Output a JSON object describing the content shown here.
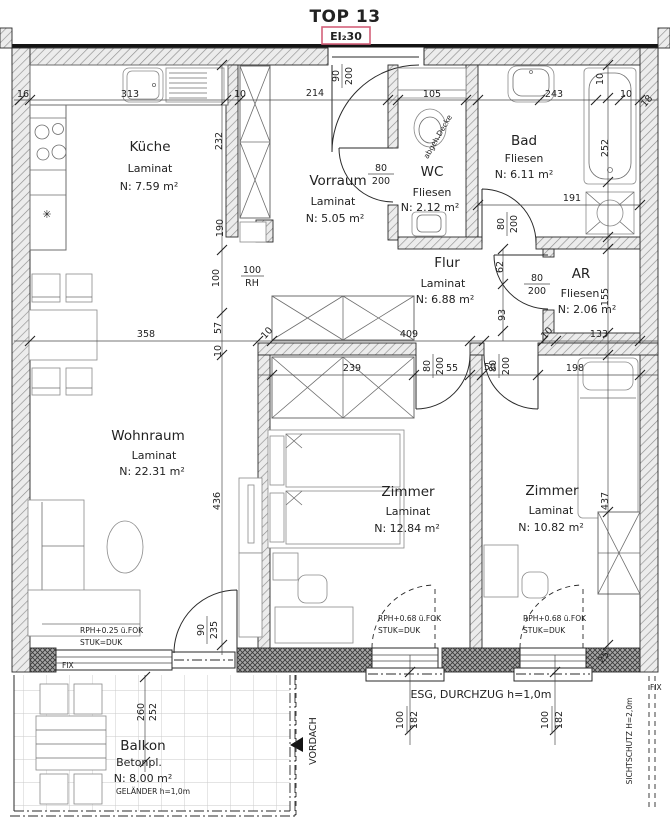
{
  "title": "TOP 13",
  "fire_label": "EI₂30",
  "rooms": {
    "kueche": {
      "name": "Küche",
      "floor": "Laminat",
      "area": "N: 7.59 m²"
    },
    "vorraum": {
      "name": "Vorraum",
      "floor": "Laminat",
      "area": "N: 5.05 m²"
    },
    "wc": {
      "name": "WC",
      "floor": "Fliesen",
      "area": "N: 2.12 m²"
    },
    "bad": {
      "name": "Bad",
      "floor": "Fliesen",
      "area": "N: 6.11 m²"
    },
    "flur": {
      "name": "Flur",
      "floor": "Laminat",
      "area": "N: 6.88 m²"
    },
    "ar": {
      "name": "AR",
      "floor": "Fliesen",
      "area": "N: 2.06 m²"
    },
    "wohnraum": {
      "name": "Wohnraum",
      "floor": "Laminat",
      "area": "N: 22.31 m²"
    },
    "zimmer1": {
      "name": "Zimmer",
      "floor": "Laminat",
      "area": "N: 12.84 m²"
    },
    "zimmer2": {
      "name": "Zimmer",
      "floor": "Laminat",
      "area": "N: 10.82 m²"
    },
    "balkon": {
      "name": "Balkon",
      "floor": "Betonpl.",
      "area": "N: 8.00 m²",
      "railing": "GELÄNDER h=1,0m"
    }
  },
  "dims": {
    "d16": "16",
    "d313": "313",
    "d10_kueche": "10",
    "d214": "214",
    "d105": "105",
    "d243": "243",
    "d10_bad_t": "10",
    "d10_bad_r": "10",
    "d18": "18",
    "d232": "232",
    "d190": "190",
    "d100": "100",
    "d57": "57",
    "d10_a": "10",
    "d10_b": "10",
    "d358": "358",
    "d409": "409",
    "d239": "239",
    "d55": "55",
    "d50": "50",
    "d198": "198",
    "d10_c": "10",
    "d133": "133",
    "d155": "155",
    "d62": "62",
    "d93": "93",
    "d252_bad": "252",
    "d191": "191",
    "d436": "436",
    "d437": "437",
    "d25": "25",
    "opening_rh": {
      "w": "100",
      "h": "RH"
    },
    "door_entry": {
      "w": "90",
      "h": "200"
    },
    "door_wc": {
      "w": "80",
      "h": "200"
    },
    "door_bad": {
      "w": "80",
      "h": "200"
    },
    "door_ar": {
      "w": "80",
      "h": "200"
    },
    "door_z1": {
      "w": "80",
      "h": "200"
    },
    "door_z2": {
      "w": "80",
      "h": "200"
    },
    "door_balkon": {
      "w": "90",
      "h": "235"
    },
    "win_z1": {
      "w": "100",
      "h": "182"
    },
    "win_z2": {
      "w": "100",
      "h": "182"
    },
    "balkon_depth": {
      "a": "260",
      "b": "252"
    }
  },
  "annotations": {
    "abgeh_decke": "abgeh.Decke",
    "fix_wohnraum": "FIX",
    "fix_right": "FIX",
    "rph_wohnraum": "RPH+0.25 ü.FOK",
    "stuk_wohnraum": "STUK=DUK",
    "rph_zimmer1": "RPH+0.68 ü.FOK",
    "stuk_zimmer1": "STUK=DUK",
    "rph_zimmer2": "RPH+0.68 ü.FOK",
    "stuk_zimmer2": "STUK=DUK",
    "esg": "ESG, DURCHZUG h=1,0m",
    "vordach": "VORDACH",
    "sichtschutz": "SICHTSCHUTZ H=2,0m"
  },
  "colors": {
    "line": "#222222",
    "hatch": "#8f8f8f",
    "fire_box": "#d4607a"
  }
}
